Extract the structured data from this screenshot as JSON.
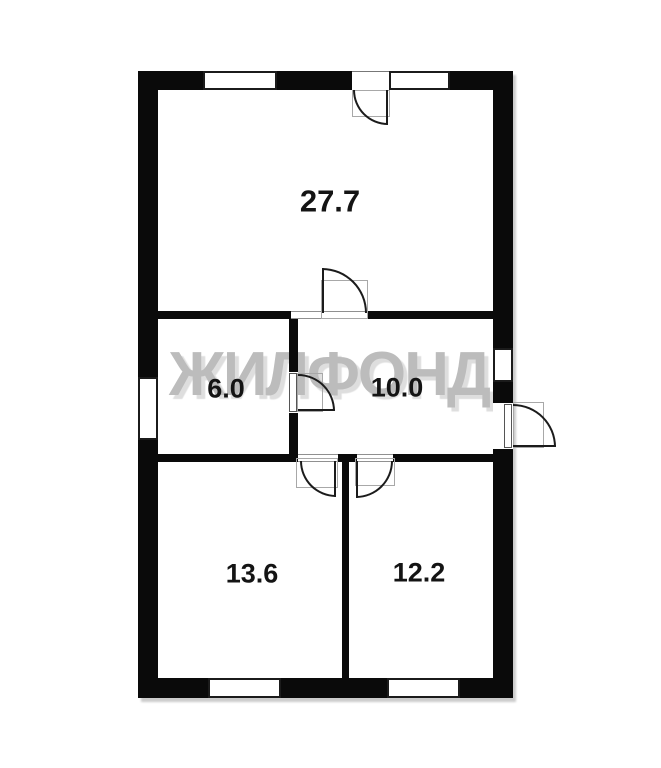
{
  "watermark": {
    "text": "ЖИЛФОНД"
  },
  "rooms": [
    {
      "name": "room-living",
      "area_label": "27.7"
    },
    {
      "name": "room-kitchen",
      "area_label": "6.0"
    },
    {
      "name": "room-hall",
      "area_label": "10.0"
    },
    {
      "name": "room-bedroom1",
      "area_label": "13.6"
    },
    {
      "name": "room-bedroom2",
      "area_label": "12.2"
    }
  ],
  "colors": {
    "background": "#ffffff",
    "walls": "#0a0a0a",
    "watermark": "#bcbcbc",
    "watermark_shadow": "#dedede",
    "room_label": "#141414"
  }
}
